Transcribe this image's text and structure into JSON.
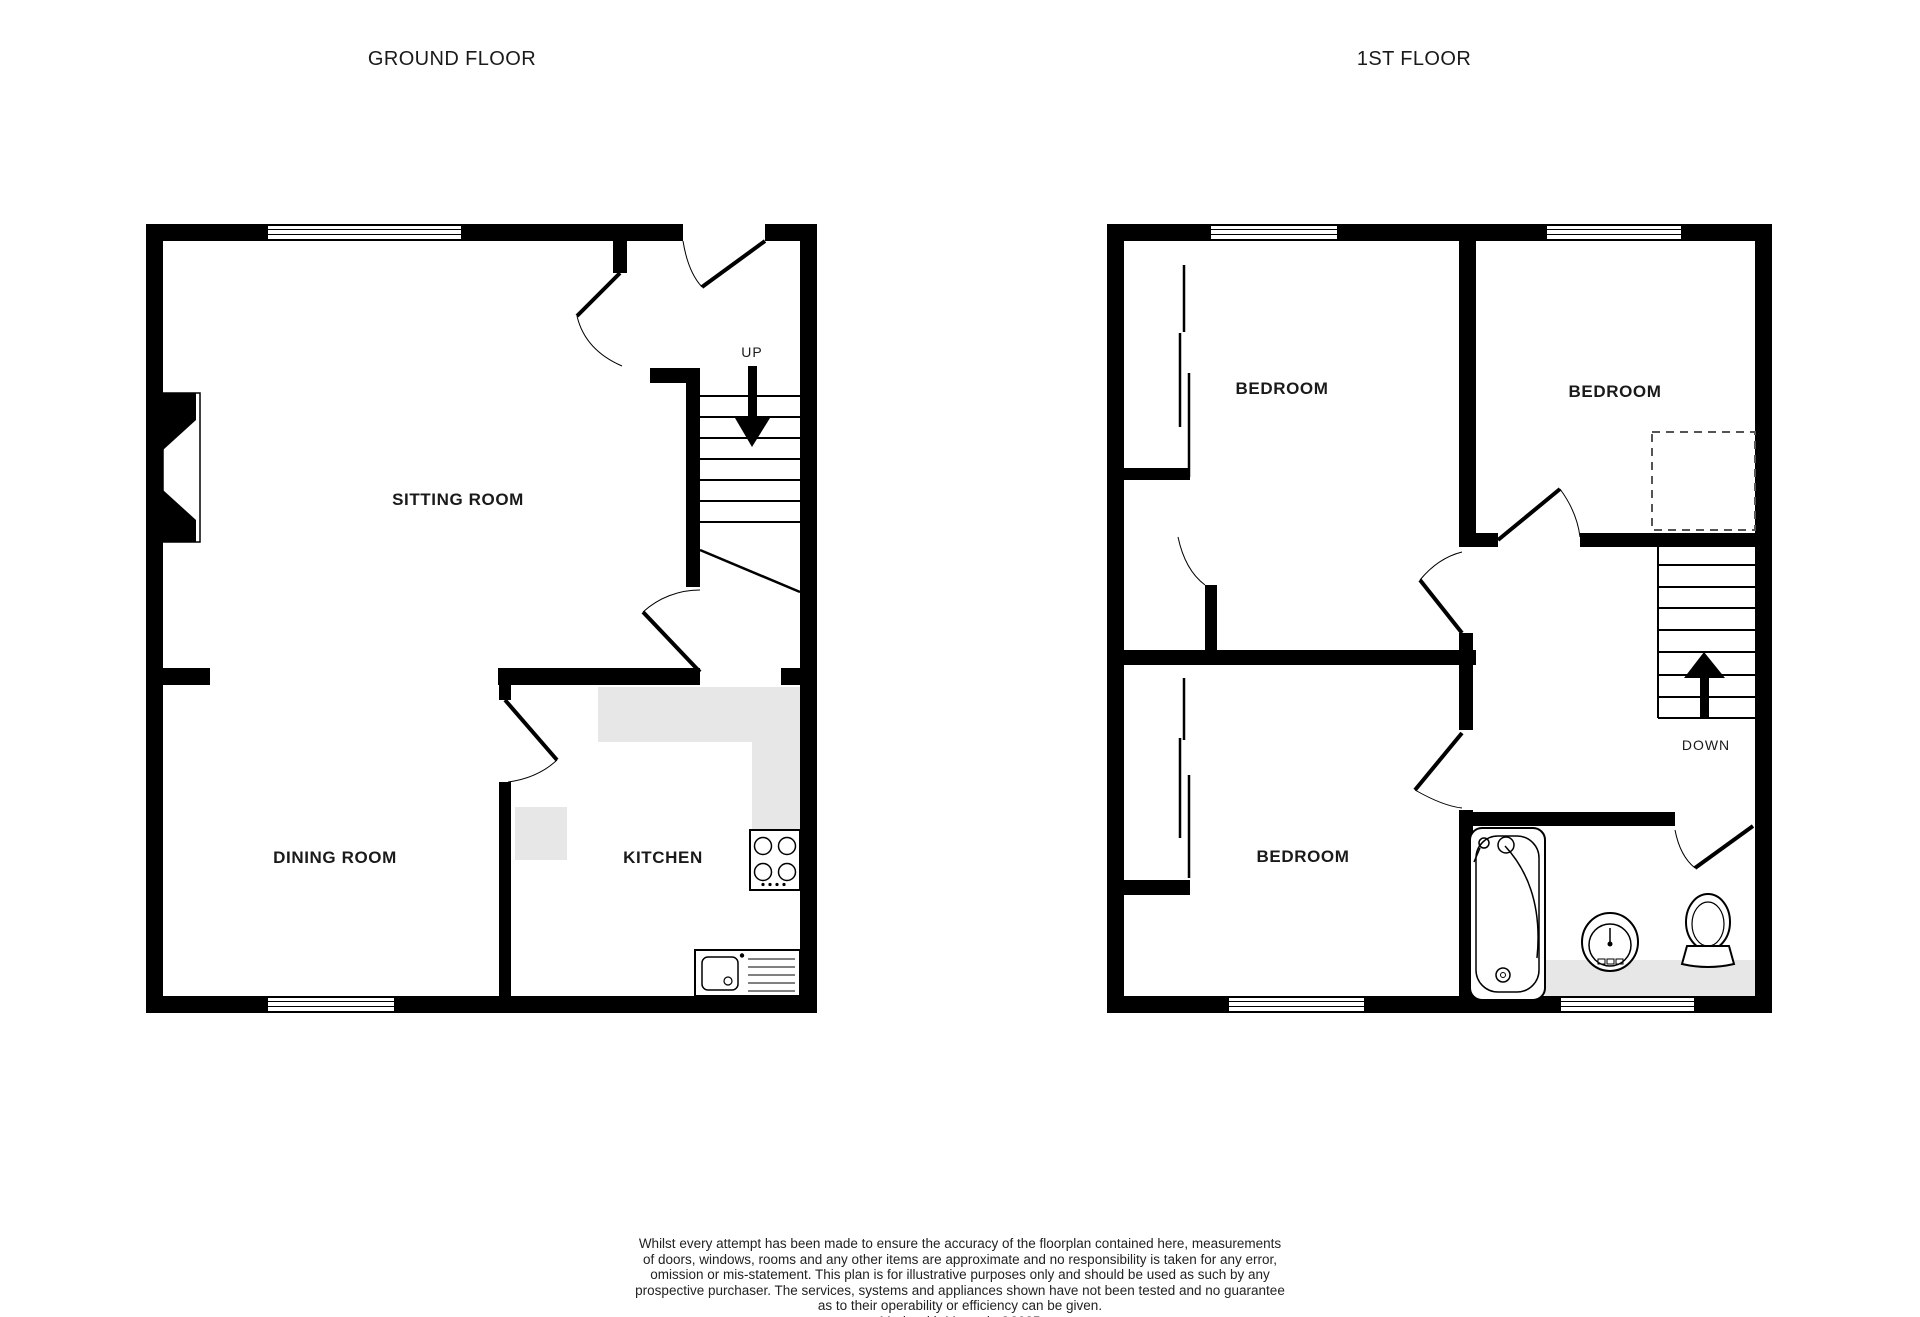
{
  "page": {
    "background": "#ffffff",
    "wall_color": "#000000",
    "counter_color": "#e7e7e7",
    "text_color": "#1a1a1a"
  },
  "titles": {
    "ground": "GROUND FLOOR",
    "first": "1ST FLOOR"
  },
  "ground_floor": {
    "rooms": [
      {
        "label": "SITTING ROOM"
      },
      {
        "label": "DINING ROOM"
      },
      {
        "label": "KITCHEN"
      }
    ],
    "stairs_label": "UP",
    "icons": [
      "fireplace-icon",
      "hob-icon",
      "kitchen-sink-icon",
      "window-icon",
      "door-icon",
      "stairs-up-arrow-icon"
    ]
  },
  "first_floor": {
    "rooms": [
      {
        "label": "BEDROOM"
      },
      {
        "label": "BEDROOM"
      },
      {
        "label": "BEDROOM"
      }
    ],
    "stairs_label": "DOWN",
    "icons": [
      "wardrobe-icon",
      "bath-icon",
      "basin-icon",
      "toilet-icon",
      "window-icon",
      "door-icon",
      "stairs-down-arrow-icon"
    ]
  },
  "disclaimer": {
    "lines": [
      "Whilst every attempt has been made to ensure the accuracy of the floorplan contained here, measurements",
      "of doors, windows, rooms and any other items are approximate and no responsibility is taken for any error,",
      "omission or mis-statement. This plan is for illustrative purposes only and should be used as such by any",
      "prospective purchaser. The services, systems and appliances shown have not been tested and no guarantee",
      "as to their operability or efficiency can be given."
    ],
    "credit": "Made with Metropix ©2025"
  }
}
